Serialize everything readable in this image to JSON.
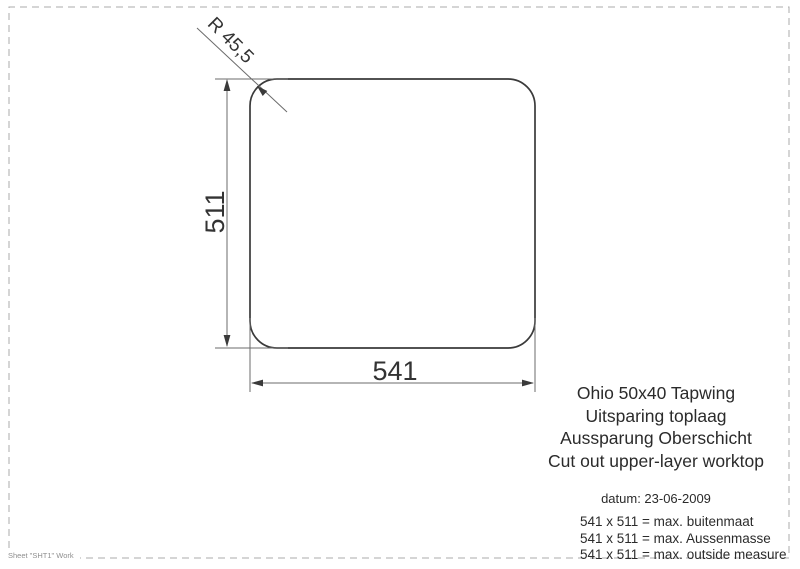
{
  "drawing": {
    "radius_label": "R 45,5",
    "height_label": "511",
    "width_label": "541"
  },
  "title_block": {
    "lines": [
      "Ohio 50x40 Tapwing",
      "Uitsparing toplaag",
      "Aussparung Oberschicht",
      "Cut out upper-layer worktop"
    ]
  },
  "notes": {
    "date": "datum: 23-06-2009",
    "measures": [
      "541 x 511 = max. buitenmaat",
      "541 x 511 = max. Aussenmasse",
      "541 x 511 = max. outside measure"
    ]
  },
  "footer": {
    "sheet_label": "Sheet \"SHT1\" Work"
  },
  "colors": {
    "outline": "#3a3a3a",
    "dimension_lines": "#6b6b6b",
    "text": "#2b2b2b",
    "border_dashed": "#ababab"
  }
}
